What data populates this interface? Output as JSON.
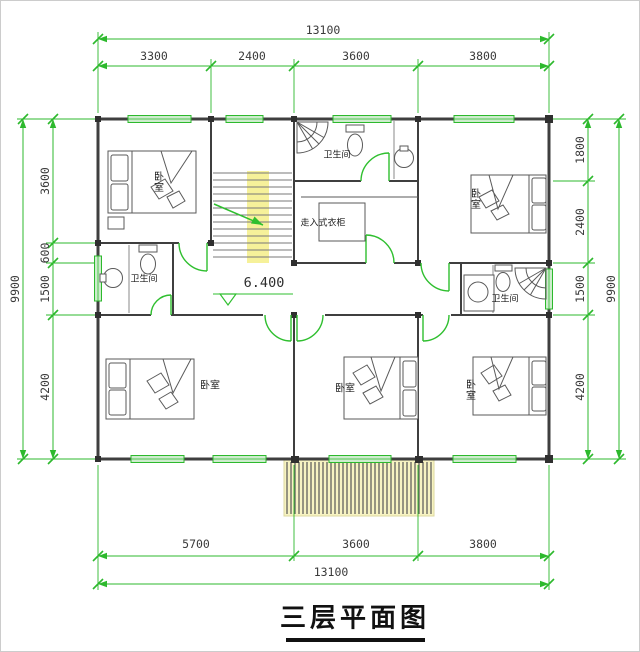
{
  "title": {
    "text": "三层平面图"
  },
  "annotations": {
    "corridor_elevation": "6.400"
  },
  "rooms": {
    "bedroom_top_left": "卧室",
    "bedroom_top_right": "卧室",
    "bedroom_bottom_left": "卧室",
    "bedroom_bottom_middle": "卧室",
    "bedroom_bottom_right": "卧室",
    "bathroom_top": "卫生间",
    "bathroom_left": "卫生间",
    "bathroom_right": "卫生间",
    "walk_in_closet": "走入式衣柜"
  },
  "dimensions": {
    "top": {
      "total": "13100",
      "segments": [
        "3300",
        "2400",
        "3600",
        "3800"
      ]
    },
    "bottom": {
      "total": "13100",
      "segments": [
        "5700",
        "3600",
        "3800"
      ]
    },
    "left": {
      "total": "9900",
      "segments": [
        "3600",
        "600",
        "1500",
        "4200"
      ]
    },
    "right": {
      "total": "9900",
      "segments": [
        "1800",
        "2400",
        "1500",
        "4200"
      ]
    }
  },
  "colors": {
    "dimension_green": "#2db92d",
    "door_green": "#2fbf2f",
    "wall_gray": "#3f3f3f",
    "stair_highlight_yellow": "#f6f19a",
    "window_fill_green": "#cdeccd",
    "balcony_tint_yellow": "#f7f3c2"
  }
}
